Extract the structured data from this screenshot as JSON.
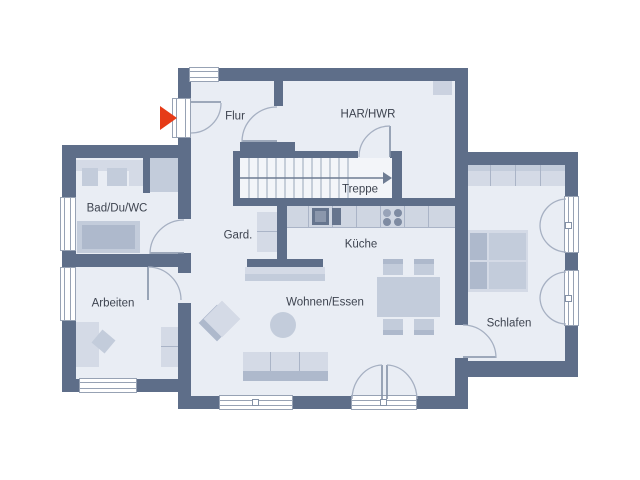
{
  "plan": {
    "type": "residential-floor-plan",
    "floor": "ground-floor"
  },
  "rooms": {
    "flur": {
      "label": "Flur"
    },
    "har_hwr": {
      "label": "HAR/HWR"
    },
    "treppe": {
      "label": "Treppe"
    },
    "bad_du_wc": {
      "label": "Bad/Du/WC"
    },
    "gard": {
      "label": "Gard."
    },
    "kueche": {
      "label": "Küche"
    },
    "arbeiten": {
      "label": "Arbeiten"
    },
    "wohnen_essen": {
      "label": "Wohnen/Essen"
    },
    "schlafen": {
      "label": "Schlafen"
    }
  },
  "icons": {
    "entrance_arrow": "entrance-arrow",
    "stair_direction_arrow": "stair-direction-arrow"
  },
  "colors": {
    "wall": "#5e6e89",
    "floor": "#e9edf4",
    "floor_light": "#f3f5f9",
    "furn_light": "#d4dae6",
    "furn_mid": "#c3ccdb",
    "furn_dark": "#aeb9cc",
    "counter": "#cfd6e2",
    "appliance": "#66758e",
    "appliance_inner": "#8b97ac",
    "burner_light": "#98a3b8",
    "burner_dark": "#7e8ba2",
    "accent": "#e63b17",
    "text": "#3e4450",
    "frame": "#97a2b4",
    "arc": "#a6b0c2",
    "leaf": "#8491a6",
    "tread": "#9aa6b9",
    "dir": "#6e7c93",
    "shaft": "#cbd2e0",
    "seam": "#aab4c7"
  }
}
